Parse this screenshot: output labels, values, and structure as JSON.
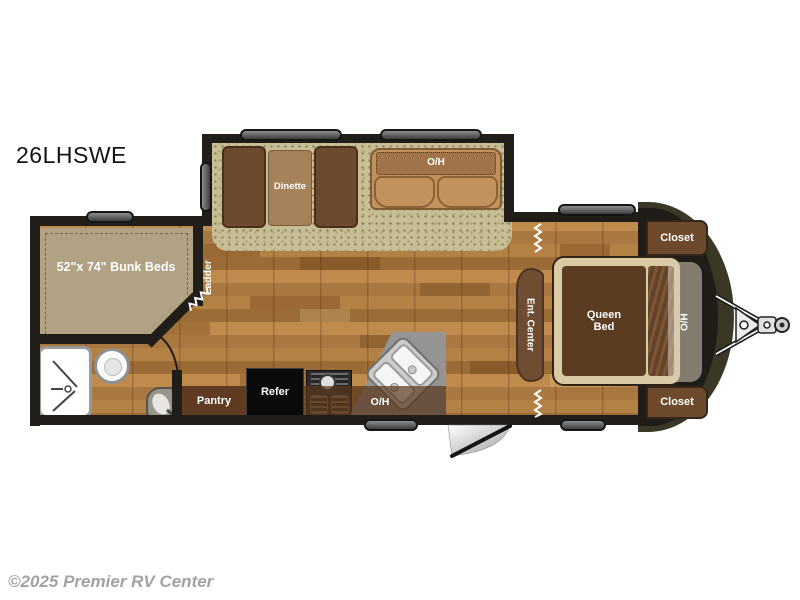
{
  "title": "26LHSWE",
  "watermark": "©2025 Premier RV Center",
  "labels": {
    "bunk_beds": "52\"x 74\" Bunk Beds",
    "ladder": "Ladder",
    "dinette": "Dinette",
    "sofa_overhead": "O/H",
    "pantry": "Pantry",
    "refrigerator": "Refer",
    "kitchen_overhead": "O/H",
    "ent_center": "Ent. Center",
    "queen_bed": "Queen Bed",
    "bed_overhead": "O/H",
    "closet_top": "Closet",
    "closet_bottom": "Closet"
  },
  "colors": {
    "wood_floor": "#b0803f",
    "carpet": "#c7be95",
    "cabinet_brown": "#6d4a2b",
    "wall": "#211d18",
    "front_cap": "#3a3724",
    "bed_mattress": "#5a3d21",
    "bunk_mattress": "#b1a283",
    "sofa": "#c2925c",
    "counter": "#949494"
  }
}
